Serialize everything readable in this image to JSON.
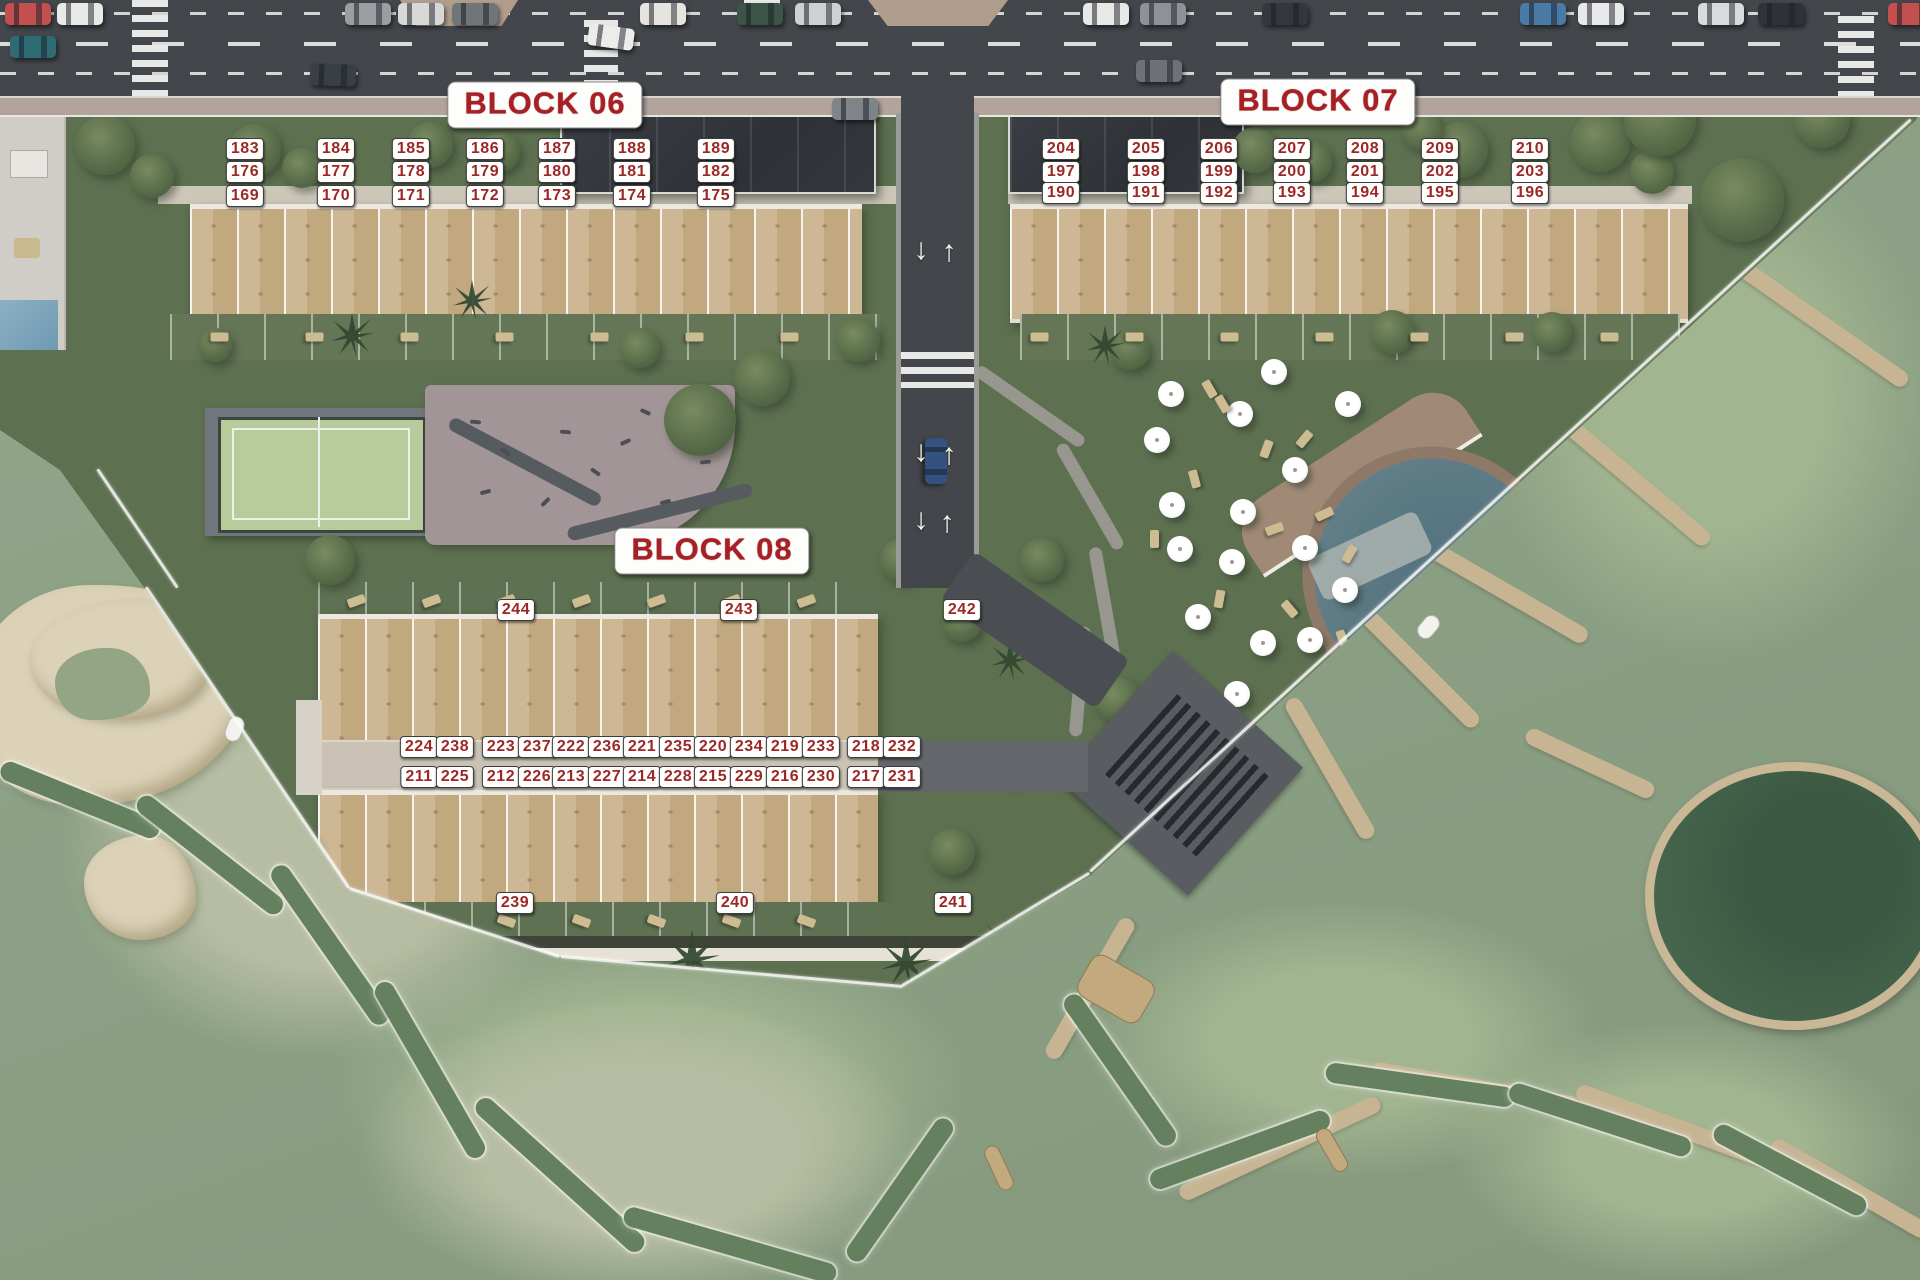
{
  "scene": {
    "title": "Residential golf resort masterplan",
    "block_06": {
      "label": "BLOCK 06",
      "units_row_top": [
        "183",
        "184",
        "185",
        "186",
        "187",
        "188",
        "189"
      ],
      "units_row_middle": [
        "176",
        "177",
        "178",
        "179",
        "180",
        "181",
        "182"
      ],
      "units_row_bottom": [
        "169",
        "170",
        "171",
        "172",
        "173",
        "174",
        "175"
      ]
    },
    "block_07": {
      "label": "BLOCK 07",
      "units_row_top": [
        "204",
        "205",
        "206",
        "207",
        "208",
        "209",
        "210"
      ],
      "units_row_middle": [
        "197",
        "198",
        "199",
        "200",
        "201",
        "202",
        "203"
      ],
      "units_row_bottom": [
        "190",
        "191",
        "192",
        "193",
        "194",
        "195",
        "196"
      ]
    },
    "block_08": {
      "label": "BLOCK 08",
      "units_top": [
        "244",
        "243",
        "242"
      ],
      "unit_pairs_row1": [
        [
          "224",
          "238"
        ],
        [
          "223",
          "237"
        ],
        [
          "222",
          "236"
        ],
        [
          "221",
          "235"
        ],
        [
          "220",
          "234"
        ],
        [
          "219",
          "233"
        ],
        [
          "218",
          "232"
        ]
      ],
      "unit_pairs_row2": [
        [
          "211",
          "225"
        ],
        [
          "212",
          "226"
        ],
        [
          "213",
          "227"
        ],
        [
          "214",
          "228"
        ],
        [
          "215",
          "229"
        ],
        [
          "216",
          "230"
        ],
        [
          "217",
          "231"
        ]
      ],
      "units_bottom": [
        "239",
        "240",
        "241"
      ]
    },
    "icons": {
      "road_arrow_up": "↑",
      "road_arrow_down": "↓"
    },
    "colors": {
      "badge_bg": "#ffffff",
      "badge_text": "#9b2727",
      "block_label_text": "#a81f24",
      "asphalt": "#43474c",
      "golf_green": "#8ca086",
      "parcel_green": "#5d7050",
      "sand": "#dbd2b8",
      "pool_water": "#5c7883",
      "path_tan": "#c6b493"
    }
  }
}
